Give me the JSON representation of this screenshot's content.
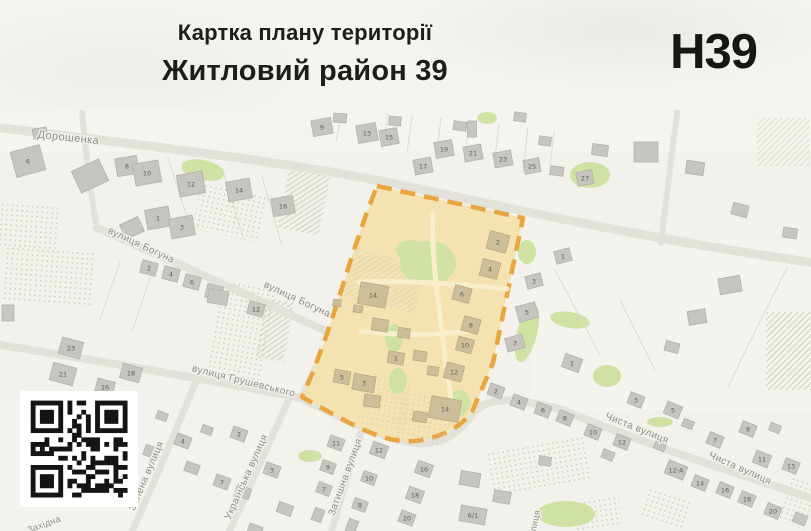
{
  "header": {
    "doc_type": "Картка плану території",
    "title": "Житловий район 39",
    "code": "Н39"
  },
  "colors": {
    "map_background": "#f2f1eb",
    "road": "#e3e2da",
    "building": "#c6c5c0",
    "building_in_zone": "#cdbe9a",
    "zone_fill": "#f4e2b1",
    "zone_border": "#e9a53e",
    "green_area": "#cfe2a4",
    "street_label": "#8e8d86",
    "header_text": "#1d1d1b"
  },
  "map": {
    "street_labels": [
      {
        "text": "Дорошенка",
        "x": 68,
        "y": 141,
        "rot": 6,
        "s": 11
      },
      {
        "text": "вулиця Богуна",
        "x": 140,
        "y": 248,
        "rot": 25,
        "s": 10
      },
      {
        "text": "вулиця Богуна",
        "x": 296,
        "y": 302,
        "rot": 25,
        "s": 10
      },
      {
        "text": "вулиця Грушевського",
        "x": 243,
        "y": 384,
        "rot": 14,
        "s": 10
      },
      {
        "text": "Затишна вулиця",
        "x": 348,
        "y": 478,
        "rot": -70,
        "s": 10
      },
      {
        "text": "Зелена вулиця",
        "x": 149,
        "y": 477,
        "rot": -67,
        "s": 10
      },
      {
        "text": "Українська вулиця",
        "x": 249,
        "y": 478,
        "rot": -66,
        "s": 10
      },
      {
        "text": "Чиста вулиця",
        "x": 636,
        "y": 431,
        "rot": 22,
        "s": 10
      },
      {
        "text": "Чиста вулиця",
        "x": 739,
        "y": 471,
        "rot": 24,
        "s": 10
      },
      {
        "text": "вулиця",
        "x": 537,
        "y": 526,
        "rot": -78,
        "s": 9
      },
      {
        "text": "Західна",
        "x": 45,
        "y": 527,
        "rot": -20,
        "s": 9
      }
    ],
    "buildings": [
      {
        "n": "6",
        "x": 28,
        "y": 161,
        "w": 30,
        "h": 26,
        "r": -15
      },
      {
        "n": "8",
        "x": 127,
        "y": 166,
        "w": 22,
        "h": 18,
        "r": -10
      },
      {
        "n": "10",
        "x": 147,
        "y": 173,
        "w": 26,
        "h": 22,
        "r": -10
      },
      {
        "n": "12",
        "x": 191,
        "y": 184,
        "w": 26,
        "h": 22,
        "r": -10
      },
      {
        "n": "14",
        "x": 239,
        "y": 190,
        "w": 24,
        "h": 20,
        "r": -10
      },
      {
        "n": "16",
        "x": 283,
        "y": 206,
        "w": 22,
        "h": 18,
        "r": -10
      },
      {
        "n": "1",
        "x": 158,
        "y": 218,
        "w": 24,
        "h": 20,
        "r": -10
      },
      {
        "n": "3",
        "x": 182,
        "y": 227,
        "w": 24,
        "h": 20,
        "r": -10
      },
      {
        "n": "9",
        "x": 322,
        "y": 127,
        "w": 20,
        "h": 16,
        "r": -10
      },
      {
        "n": "13",
        "x": 367,
        "y": 133,
        "w": 20,
        "h": 18,
        "r": -10
      },
      {
        "n": "15",
        "x": 389,
        "y": 137,
        "w": 18,
        "h": 16,
        "r": -10
      },
      {
        "n": "17",
        "x": 423,
        "y": 166,
        "w": 18,
        "h": 15,
        "r": -10
      },
      {
        "n": "19",
        "x": 444,
        "y": 149,
        "w": 18,
        "h": 16,
        "r": -10
      },
      {
        "n": "21",
        "x": 473,
        "y": 153,
        "w": 18,
        "h": 15,
        "r": -10
      },
      {
        "n": "23",
        "x": 503,
        "y": 159,
        "w": 18,
        "h": 15,
        "r": -10
      },
      {
        "n": "25",
        "x": 532,
        "y": 166,
        "w": 16,
        "h": 14,
        "r": -10
      },
      {
        "n": "27",
        "x": 585,
        "y": 178,
        "w": 16,
        "h": 14,
        "r": -10
      },
      {
        "n": "2",
        "x": 149,
        "y": 268,
        "w": 16,
        "h": 13,
        "r": 15
      },
      {
        "n": "4",
        "x": 171,
        "y": 274,
        "w": 16,
        "h": 13,
        "r": 15
      },
      {
        "n": "6",
        "x": 192,
        "y": 282,
        "w": 16,
        "h": 13,
        "r": 15
      },
      {
        "n": "8",
        "x": 214,
        "y": 292,
        "w": 16,
        "h": 14,
        "r": 15
      },
      {
        "n": "12",
        "x": 256,
        "y": 309,
        "w": 16,
        "h": 13,
        "r": 15
      },
      {
        "n": "23",
        "x": 71,
        "y": 348,
        "w": 22,
        "h": 17,
        "r": 15
      },
      {
        "n": "21",
        "x": 63,
        "y": 374,
        "w": 24,
        "h": 18,
        "r": 15
      },
      {
        "n": "18",
        "x": 131,
        "y": 373,
        "w": 20,
        "h": 15,
        "r": 15
      },
      {
        "n": "16",
        "x": 105,
        "y": 387,
        "w": 18,
        "h": 14,
        "r": 15
      },
      {
        "n": "3",
        "x": 534,
        "y": 281,
        "w": 16,
        "h": 13,
        "r": -15
      },
      {
        "n": "5",
        "x": 527,
        "y": 312,
        "w": 20,
        "h": 16,
        "r": -15
      },
      {
        "n": "7",
        "x": 515,
        "y": 343,
        "w": 18,
        "h": 14,
        "r": -15
      },
      {
        "n": "1",
        "x": 563,
        "y": 256,
        "w": 16,
        "h": 13,
        "r": -15
      },
      {
        "n": "1",
        "x": 572,
        "y": 363,
        "w": 18,
        "h": 14,
        "r": 20
      },
      {
        "n": "2",
        "x": 496,
        "y": 391,
        "w": 15,
        "h": 12,
        "r": 20
      },
      {
        "n": "4",
        "x": 519,
        "y": 402,
        "w": 15,
        "h": 12,
        "r": 20
      },
      {
        "n": "6",
        "x": 543,
        "y": 410,
        "w": 15,
        "h": 12,
        "r": 20
      },
      {
        "n": "2",
        "x": 239,
        "y": 434,
        "w": 15,
        "h": 12,
        "r": 20
      },
      {
        "n": "4",
        "x": 183,
        "y": 441,
        "w": 15,
        "h": 12,
        "r": 20
      },
      {
        "n": "7",
        "x": 222,
        "y": 482,
        "w": 15,
        "h": 12,
        "r": 20
      },
      {
        "n": "3",
        "x": 272,
        "y": 470,
        "w": 15,
        "h": 12,
        "r": 20
      },
      {
        "n": "11",
        "x": 336,
        "y": 443,
        "w": 15,
        "h": 12,
        "r": 20
      },
      {
        "n": "12",
        "x": 379,
        "y": 450,
        "w": 16,
        "h": 13,
        "r": 20
      },
      {
        "n": "9",
        "x": 328,
        "y": 467,
        "w": 14,
        "h": 11,
        "r": 20
      },
      {
        "n": "16",
        "x": 424,
        "y": 469,
        "w": 16,
        "h": 13,
        "r": 20
      },
      {
        "n": "10",
        "x": 369,
        "y": 478,
        "w": 14,
        "h": 11,
        "r": 20
      },
      {
        "n": "7",
        "x": 324,
        "y": 489,
        "w": 14,
        "h": 11,
        "r": 20
      },
      {
        "n": "18",
        "x": 415,
        "y": 495,
        "w": 16,
        "h": 13,
        "r": 20
      },
      {
        "n": "8",
        "x": 360,
        "y": 505,
        "w": 14,
        "h": 11,
        "r": 20
      },
      {
        "n": "20",
        "x": 407,
        "y": 518,
        "w": 15,
        "h": 12,
        "r": 20
      },
      {
        "n": "6/1",
        "x": 473,
        "y": 515,
        "w": 26,
        "h": 16,
        "r": 10
      },
      {
        "n": "8",
        "x": 565,
        "y": 418,
        "w": 15,
        "h": 12,
        "r": 22
      },
      {
        "n": "10",
        "x": 593,
        "y": 432,
        "w": 15,
        "h": 12,
        "r": 22
      },
      {
        "n": "12",
        "x": 622,
        "y": 442,
        "w": 15,
        "h": 12,
        "r": 22
      },
      {
        "n": "3",
        "x": 636,
        "y": 400,
        "w": 15,
        "h": 12,
        "r": 22
      },
      {
        "n": "5",
        "x": 673,
        "y": 410,
        "w": 16,
        "h": 13,
        "r": 22
      },
      {
        "n": "7",
        "x": 715,
        "y": 440,
        "w": 15,
        "h": 12,
        "r": 22
      },
      {
        "n": "9",
        "x": 748,
        "y": 429,
        "w": 15,
        "h": 12,
        "r": 22
      },
      {
        "n": "11",
        "x": 762,
        "y": 459,
        "w": 16,
        "h": 13,
        "r": 22
      },
      {
        "n": "13",
        "x": 791,
        "y": 466,
        "w": 15,
        "h": 12,
        "r": 22
      },
      {
        "n": "12-А",
        "x": 676,
        "y": 470,
        "w": 20,
        "h": 14,
        "r": 22
      },
      {
        "n": "14",
        "x": 700,
        "y": 483,
        "w": 15,
        "h": 12,
        "r": 22
      },
      {
        "n": "16",
        "x": 725,
        "y": 490,
        "w": 15,
        "h": 12,
        "r": 22
      },
      {
        "n": "18",
        "x": 747,
        "y": 499,
        "w": 15,
        "h": 12,
        "r": 22
      },
      {
        "n": "20",
        "x": 773,
        "y": 511,
        "w": 15,
        "h": 12,
        "r": 22
      },
      {
        "n": "",
        "x": 40,
        "y": 133,
        "w": 14,
        "h": 10,
        "r": -10
      },
      {
        "n": "",
        "x": 90,
        "y": 176,
        "w": 30,
        "h": 24,
        "r": -25
      },
      {
        "n": "",
        "x": 132,
        "y": 228,
        "w": 20,
        "h": 16,
        "r": -25
      },
      {
        "n": "",
        "x": 218,
        "y": 297,
        "w": 20,
        "h": 14,
        "r": 10
      },
      {
        "n": "",
        "x": 8,
        "y": 313,
        "w": 12,
        "h": 16,
        "r": 0
      },
      {
        "n": "",
        "x": 340,
        "y": 118,
        "w": 13,
        "h": 9,
        "r": 5
      },
      {
        "n": "",
        "x": 395,
        "y": 121,
        "w": 12,
        "h": 9,
        "r": 5
      },
      {
        "n": "",
        "x": 460,
        "y": 126,
        "w": 13,
        "h": 9,
        "r": 8
      },
      {
        "n": "",
        "x": 520,
        "y": 117,
        "w": 12,
        "h": 9,
        "r": 8
      },
      {
        "n": "",
        "x": 472,
        "y": 129,
        "w": 9,
        "h": 16,
        "r": 0
      },
      {
        "n": "",
        "x": 545,
        "y": 141,
        "w": 12,
        "h": 9,
        "r": 8
      },
      {
        "n": "",
        "x": 557,
        "y": 171,
        "w": 13,
        "h": 9,
        "r": 8
      },
      {
        "n": "",
        "x": 600,
        "y": 150,
        "w": 16,
        "h": 11,
        "r": 8
      },
      {
        "n": "",
        "x": 646,
        "y": 152,
        "w": 24,
        "h": 20,
        "r": 0
      },
      {
        "n": "",
        "x": 695,
        "y": 168,
        "w": 18,
        "h": 13,
        "r": 8
      },
      {
        "n": "",
        "x": 740,
        "y": 210,
        "w": 16,
        "h": 12,
        "r": 15
      },
      {
        "n": "",
        "x": 790,
        "y": 233,
        "w": 14,
        "h": 10,
        "r": 8
      },
      {
        "n": "",
        "x": 730,
        "y": 285,
        "w": 22,
        "h": 16,
        "r": -10
      },
      {
        "n": "",
        "x": 697,
        "y": 317,
        "w": 18,
        "h": 14,
        "r": -10
      },
      {
        "n": "",
        "x": 672,
        "y": 347,
        "w": 14,
        "h": 10,
        "r": 15
      },
      {
        "n": "",
        "x": 608,
        "y": 455,
        "w": 12,
        "h": 9,
        "r": 22
      },
      {
        "n": "",
        "x": 660,
        "y": 446,
        "w": 11,
        "h": 8,
        "r": 22
      },
      {
        "n": "",
        "x": 688,
        "y": 424,
        "w": 11,
        "h": 8,
        "r": 22
      },
      {
        "n": "",
        "x": 775,
        "y": 428,
        "w": 11,
        "h": 8,
        "r": 22
      },
      {
        "n": "",
        "x": 800,
        "y": 519,
        "w": 13,
        "h": 10,
        "r": 22
      },
      {
        "n": "",
        "x": 55,
        "y": 425,
        "w": 18,
        "h": 12,
        "r": 20
      },
      {
        "n": "",
        "x": 100,
        "y": 437,
        "w": 16,
        "h": 11,
        "r": 20
      },
      {
        "n": "",
        "x": 152,
        "y": 452,
        "w": 16,
        "h": 11,
        "r": 20
      },
      {
        "n": "",
        "x": 192,
        "y": 468,
        "w": 14,
        "h": 10,
        "r": 20
      },
      {
        "n": "",
        "x": 243,
        "y": 492,
        "w": 15,
        "h": 11,
        "r": 20
      },
      {
        "n": "",
        "x": 285,
        "y": 509,
        "w": 15,
        "h": 11,
        "r": 20
      },
      {
        "n": "",
        "x": 207,
        "y": 430,
        "w": 11,
        "h": 8,
        "r": 20
      },
      {
        "n": "",
        "x": 162,
        "y": 416,
        "w": 11,
        "h": 8,
        "r": 20
      },
      {
        "n": "",
        "x": 318,
        "y": 515,
        "w": 13,
        "h": 10,
        "r": -70
      },
      {
        "n": "",
        "x": 352,
        "y": 526,
        "w": 13,
        "h": 10,
        "r": -70
      },
      {
        "n": "",
        "x": 255,
        "y": 530,
        "w": 14,
        "h": 10,
        "r": 20
      },
      {
        "n": "",
        "x": 470,
        "y": 479,
        "w": 20,
        "h": 14,
        "r": 10
      },
      {
        "n": "",
        "x": 502,
        "y": 497,
        "w": 17,
        "h": 12,
        "r": 10
      },
      {
        "n": "",
        "x": 545,
        "y": 461,
        "w": 12,
        "h": 9,
        "r": 10
      },
      {
        "n": "2",
        "x": 498,
        "y": 242,
        "w": 20,
        "h": 18,
        "r": 15,
        "zone": true
      },
      {
        "n": "4",
        "x": 490,
        "y": 269,
        "w": 18,
        "h": 17,
        "r": 15,
        "zone": true
      },
      {
        "n": "6",
        "x": 462,
        "y": 294,
        "w": 17,
        "h": 15,
        "r": 15,
        "zone": true
      },
      {
        "n": "8",
        "x": 471,
        "y": 325,
        "w": 17,
        "h": 15,
        "r": 15,
        "zone": true
      },
      {
        "n": "10",
        "x": 465,
        "y": 345,
        "w": 16,
        "h": 14,
        "r": 15,
        "zone": true
      },
      {
        "n": "12",
        "x": 454,
        "y": 372,
        "w": 18,
        "h": 16,
        "r": 15,
        "zone": true
      },
      {
        "n": "14",
        "x": 373,
        "y": 295,
        "w": 28,
        "h": 22,
        "r": 10,
        "zone": true
      },
      {
        "n": "1",
        "x": 396,
        "y": 358,
        "w": 16,
        "h": 12,
        "r": 10,
        "zone": true
      },
      {
        "n": "5",
        "x": 342,
        "y": 377,
        "w": 16,
        "h": 13,
        "r": 10,
        "zone": true
      },
      {
        "n": "3",
        "x": 364,
        "y": 383,
        "w": 22,
        "h": 16,
        "r": 10,
        "zone": true
      },
      {
        "n": "14",
        "x": 445,
        "y": 409,
        "w": 30,
        "h": 22,
        "r": 10,
        "zone": true
      },
      {
        "n": "",
        "x": 380,
        "y": 325,
        "w": 16,
        "h": 12,
        "r": 8,
        "zone": true
      },
      {
        "n": "",
        "x": 404,
        "y": 333,
        "w": 12,
        "h": 10,
        "r": 8,
        "zone": true
      },
      {
        "n": "",
        "x": 358,
        "y": 309,
        "w": 9,
        "h": 7,
        "r": 8,
        "zone": true
      },
      {
        "n": "",
        "x": 420,
        "y": 356,
        "w": 13,
        "h": 10,
        "r": 8,
        "zone": true
      },
      {
        "n": "",
        "x": 433,
        "y": 371,
        "w": 11,
        "h": 9,
        "r": 8,
        "zone": true
      },
      {
        "n": "",
        "x": 372,
        "y": 401,
        "w": 16,
        "h": 12,
        "r": 8,
        "zone": true
      },
      {
        "n": "",
        "x": 420,
        "y": 417,
        "w": 14,
        "h": 10,
        "r": 8,
        "zone": true
      },
      {
        "n": "",
        "x": 337,
        "y": 303,
        "w": 8,
        "h": 7,
        "r": 8,
        "zone": true
      }
    ]
  },
  "qr": {
    "modules": 21
  }
}
